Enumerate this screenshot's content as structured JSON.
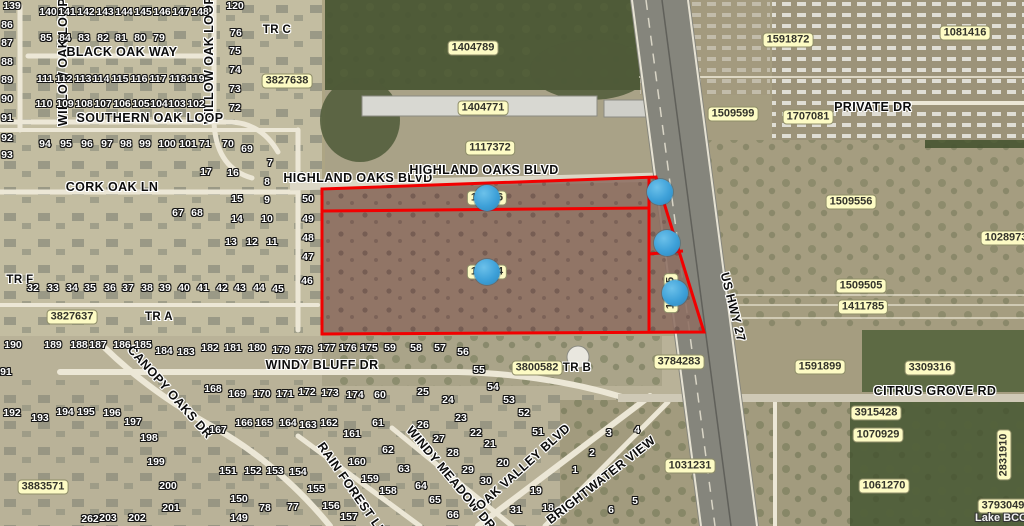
{
  "map": {
    "colors": {
      "parcel_outline": "#F20000",
      "marker_blue": "#3DA4DC",
      "label_yellow": "#FDFBC4"
    },
    "watermark": "Lake BCC",
    "parcel_labels": [
      {
        "t": "3827638",
        "x": 287,
        "y": 81,
        "rot": 0
      },
      {
        "t": "1404789",
        "x": 473,
        "y": 48,
        "rot": 0
      },
      {
        "t": "1404771",
        "x": 483,
        "y": 108,
        "rot": 0
      },
      {
        "t": "1117372",
        "x": 490,
        "y": 148,
        "rot": 0
      },
      {
        "t": "1591872",
        "x": 788,
        "y": 40,
        "rot": 0
      },
      {
        "t": "1509599",
        "x": 733,
        "y": 114,
        "rot": 0
      },
      {
        "t": "1707081",
        "x": 808,
        "y": 117,
        "rot": 0
      },
      {
        "t": "1081416",
        "x": 965,
        "y": 33,
        "rot": 0
      },
      {
        "t": "1509556",
        "x": 851,
        "y": 202,
        "rot": 0
      },
      {
        "t": "1028973",
        "x": 1006,
        "y": 238,
        "rot": 0
      },
      {
        "t": "1509505",
        "x": 861,
        "y": 286,
        "rot": 0
      },
      {
        "t": "1411785",
        "x": 863,
        "y": 307,
        "rot": 0
      },
      {
        "t": "3827637",
        "x": 72,
        "y": 317,
        "rot": 0
      },
      {
        "t": "3800582",
        "x": 537,
        "y": 368,
        "rot": 0
      },
      {
        "t": "3784283",
        "x": 679,
        "y": 362,
        "rot": 0
      },
      {
        "t": "1591899",
        "x": 820,
        "y": 367,
        "rot": 0
      },
      {
        "t": "3309316",
        "x": 930,
        "y": 368,
        "rot": 0
      },
      {
        "t": "3915428",
        "x": 876,
        "y": 413,
        "rot": 0
      },
      {
        "t": "1070929",
        "x": 878,
        "y": 435,
        "rot": 0
      },
      {
        "t": "1031231",
        "x": 690,
        "y": 466,
        "rot": 0
      },
      {
        "t": "1061270",
        "x": 884,
        "y": 486,
        "rot": 0
      },
      {
        "t": "2831910",
        "x": 1004,
        "y": 455,
        "rot": -90
      },
      {
        "t": "3793049",
        "x": 1003,
        "y": 506,
        "rot": 0
      },
      {
        "t": "3883571",
        "x": 43,
        "y": 487,
        "rot": 0
      }
    ],
    "partial_labels": [
      {
        "pre": "1",
        "suf": "6",
        "x": 487,
        "y": 198,
        "rot": 0
      },
      {
        "pre": "1",
        "suf": "4",
        "x": 487,
        "y": 272,
        "rot": 0
      },
      {
        "pre": "1",
        "suf": "5",
        "x": 671,
        "y": 293,
        "rot": -90
      }
    ],
    "street_labels": [
      {
        "t": "WILLOW OAK LOOP",
        "x": 63,
        "y": 62,
        "rot": -90
      },
      {
        "t": "WILLOW OAK LOOP",
        "x": 209,
        "y": 60,
        "rot": -90
      },
      {
        "t": "BLACK OAK WAY",
        "x": 122,
        "y": 52,
        "rot": 0
      },
      {
        "t": "SOUTHERN OAK LOOP",
        "x": 150,
        "y": 118,
        "rot": 0
      },
      {
        "t": "CORK OAK LN",
        "x": 112,
        "y": 187,
        "rot": 0
      },
      {
        "t": "HIGHLAND OAKS BLVD",
        "x": 358,
        "y": 178,
        "rot": 0
      },
      {
        "t": "HIGHLAND OAKS BLVD",
        "x": 484,
        "y": 170,
        "rot": 0
      },
      {
        "t": "PRIVATE DR",
        "x": 873,
        "y": 107,
        "rot": 0
      },
      {
        "t": "US HWY 27",
        "x": 733,
        "y": 307,
        "rot": 76
      },
      {
        "t": "CANOPY OAKS DR",
        "x": 170,
        "y": 392,
        "rot": 48
      },
      {
        "t": "WINDY BLUFF DR",
        "x": 322,
        "y": 365,
        "rot": 0
      },
      {
        "t": "RAIN FOREST LN",
        "x": 352,
        "y": 489,
        "rot": 55
      },
      {
        "t": "WINDY MEADOW DR",
        "x": 451,
        "y": 478,
        "rot": 50
      },
      {
        "t": "OAK VALLEY BLVD",
        "x": 523,
        "y": 467,
        "rot": -42
      },
      {
        "t": "BRIGHTWATER VIEW",
        "x": 601,
        "y": 480,
        "rot": -38
      },
      {
        "t": "CITRUS GROVE RD",
        "x": 935,
        "y": 391,
        "rot": 0
      },
      {
        "t": "TR C",
        "x": 277,
        "y": 30,
        "rot": 0
      },
      {
        "t": "TR F",
        "x": 20,
        "y": 280,
        "rot": 0
      },
      {
        "t": "TR A",
        "x": 159,
        "y": 317,
        "rot": 0
      },
      {
        "t": "TR B",
        "x": 577,
        "y": 368,
        "rot": 0
      }
    ],
    "lots": [
      [
        "139",
        12,
        6
      ],
      [
        "86",
        7,
        25
      ],
      [
        "87",
        7,
        43
      ],
      [
        "88",
        7,
        62
      ],
      [
        "89",
        7,
        80
      ],
      [
        "90",
        7,
        99
      ],
      [
        "91",
        7,
        118
      ],
      [
        "92",
        7,
        138
      ],
      [
        "93",
        7,
        155
      ],
      [
        "140",
        48,
        12
      ],
      [
        "141",
        67,
        12
      ],
      [
        "142",
        86,
        12
      ],
      [
        "143",
        105,
        12
      ],
      [
        "144",
        124,
        12
      ],
      [
        "145",
        143,
        12
      ],
      [
        "146",
        162,
        12
      ],
      [
        "147",
        181,
        12
      ],
      [
        "148",
        200,
        12
      ],
      [
        "85",
        46,
        38
      ],
      [
        "84",
        65,
        38
      ],
      [
        "83",
        84,
        38
      ],
      [
        "82",
        103,
        38
      ],
      [
        "81",
        121,
        38
      ],
      [
        "80",
        140,
        38
      ],
      [
        "79",
        159,
        38
      ],
      [
        "111",
        45,
        79
      ],
      [
        "112",
        64,
        79
      ],
      [
        "113",
        83,
        79
      ],
      [
        "114",
        101,
        79
      ],
      [
        "115",
        120,
        79
      ],
      [
        "116",
        139,
        79
      ],
      [
        "117",
        158,
        79
      ],
      [
        "118",
        178,
        79
      ],
      [
        "119",
        196,
        79
      ],
      [
        "110",
        44,
        104
      ],
      [
        "109",
        65,
        104
      ],
      [
        "108",
        84,
        104
      ],
      [
        "107",
        103,
        104
      ],
      [
        "106",
        122,
        104
      ],
      [
        "105",
        141,
        104
      ],
      [
        "104",
        159,
        104
      ],
      [
        "103",
        177,
        104
      ],
      [
        "102",
        196,
        104
      ],
      [
        "120",
        235,
        6
      ],
      [
        "76",
        236,
        33
      ],
      [
        "75",
        235,
        51
      ],
      [
        "74",
        235,
        70
      ],
      [
        "73",
        235,
        89
      ],
      [
        "72",
        235,
        108
      ],
      [
        "94",
        45,
        144
      ],
      [
        "95",
        66,
        144
      ],
      [
        "96",
        87,
        144
      ],
      [
        "97",
        107,
        144
      ],
      [
        "98",
        126,
        144
      ],
      [
        "99",
        145,
        144
      ],
      [
        "100",
        167,
        144
      ],
      [
        "101",
        188,
        144
      ],
      [
        "71",
        205,
        144
      ],
      [
        "70",
        228,
        144
      ],
      [
        "69",
        247,
        149
      ],
      [
        "7",
        270,
        163
      ],
      [
        "17",
        206,
        172
      ],
      [
        "16",
        233,
        173
      ],
      [
        "8",
        267,
        182
      ],
      [
        "15",
        237,
        199
      ],
      [
        "9",
        267,
        200
      ],
      [
        "67",
        178,
        213
      ],
      [
        "68",
        197,
        213
      ],
      [
        "14",
        237,
        219
      ],
      [
        "10",
        267,
        219
      ],
      [
        "13",
        231,
        242
      ],
      [
        "12",
        252,
        242
      ],
      [
        "11",
        272,
        242
      ],
      [
        "50",
        308,
        199
      ],
      [
        "49",
        308,
        219
      ],
      [
        "48",
        308,
        238
      ],
      [
        "47",
        308,
        257
      ],
      [
        "46",
        307,
        281
      ],
      [
        "45",
        278,
        289
      ],
      [
        "44",
        259,
        288
      ],
      [
        "43",
        240,
        288
      ],
      [
        "42",
        222,
        288
      ],
      [
        "41",
        203,
        288
      ],
      [
        "40",
        184,
        288
      ],
      [
        "39",
        165,
        288
      ],
      [
        "38",
        147,
        288
      ],
      [
        "37",
        128,
        288
      ],
      [
        "36",
        110,
        288
      ],
      [
        "35",
        90,
        288
      ],
      [
        "34",
        72,
        288
      ],
      [
        "33",
        53,
        288
      ],
      [
        "32",
        33,
        288
      ],
      [
        "190",
        13,
        345
      ],
      [
        "189",
        53,
        345
      ],
      [
        "188",
        79,
        345
      ],
      [
        "187",
        98,
        345
      ],
      [
        "186",
        122,
        345
      ],
      [
        "185",
        143,
        345
      ],
      [
        "184",
        164,
        351
      ],
      [
        "183",
        186,
        352
      ],
      [
        "182",
        210,
        348
      ],
      [
        "181",
        233,
        348
      ],
      [
        "180",
        257,
        348
      ],
      [
        "179",
        281,
        350
      ],
      [
        "178",
        304,
        350
      ],
      [
        "177",
        327,
        348
      ],
      [
        "176",
        348,
        348
      ],
      [
        "175",
        369,
        348
      ],
      [
        "191",
        3,
        372
      ],
      [
        "59",
        390,
        348
      ],
      [
        "58",
        416,
        348
      ],
      [
        "57",
        440,
        348
      ],
      [
        "56",
        463,
        352
      ],
      [
        "55",
        479,
        370
      ],
      [
        "54",
        493,
        387
      ],
      [
        "53",
        509,
        400
      ],
      [
        "52",
        524,
        413
      ],
      [
        "51",
        538,
        432
      ],
      [
        "172",
        307,
        392
      ],
      [
        "173",
        330,
        393
      ],
      [
        "174",
        355,
        395
      ],
      [
        "60",
        380,
        395
      ],
      [
        "25",
        423,
        392
      ],
      [
        "24",
        448,
        400
      ],
      [
        "23",
        461,
        418
      ],
      [
        "192",
        12,
        413
      ],
      [
        "193",
        40,
        418
      ],
      [
        "194",
        65,
        412
      ],
      [
        "195",
        86,
        412
      ],
      [
        "196",
        112,
        413
      ],
      [
        "197",
        133,
        422
      ],
      [
        "198",
        149,
        438
      ],
      [
        "199",
        156,
        462
      ],
      [
        "200",
        168,
        486
      ],
      [
        "201",
        171,
        508
      ],
      [
        "202",
        137,
        518
      ],
      [
        "203",
        108,
        518
      ],
      [
        "262",
        90,
        519
      ],
      [
        "168",
        213,
        389
      ],
      [
        "169",
        237,
        394
      ],
      [
        "170",
        262,
        394
      ],
      [
        "171",
        285,
        394
      ],
      [
        "167",
        218,
        430
      ],
      [
        "166",
        244,
        423
      ],
      [
        "165",
        264,
        423
      ],
      [
        "164",
        288,
        423
      ],
      [
        "151",
        228,
        471
      ],
      [
        "152",
        253,
        471
      ],
      [
        "153",
        275,
        471
      ],
      [
        "154",
        298,
        472
      ],
      [
        "155",
        316,
        489
      ],
      [
        "156",
        331,
        506
      ],
      [
        "157",
        349,
        517
      ],
      [
        "158",
        388,
        491
      ],
      [
        "159",
        370,
        479
      ],
      [
        "160",
        357,
        462
      ],
      [
        "161",
        352,
        434
      ],
      [
        "162",
        329,
        423
      ],
      [
        "163",
        308,
        425
      ],
      [
        "150",
        239,
        499
      ],
      [
        "149",
        239,
        518
      ],
      [
        "78",
        265,
        508
      ],
      [
        "77",
        293,
        507
      ],
      [
        "61",
        378,
        423
      ],
      [
        "26",
        423,
        425
      ],
      [
        "22",
        476,
        433
      ],
      [
        "27",
        439,
        439
      ],
      [
        "62",
        388,
        450
      ],
      [
        "21",
        490,
        444
      ],
      [
        "28",
        453,
        453
      ],
      [
        "20",
        503,
        463
      ],
      [
        "29",
        468,
        470
      ],
      [
        "63",
        404,
        469
      ],
      [
        "30",
        486,
        481
      ],
      [
        "19",
        536,
        491
      ],
      [
        "64",
        421,
        486
      ],
      [
        "65",
        435,
        500
      ],
      [
        "31",
        516,
        510
      ],
      [
        "18",
        548,
        508
      ],
      [
        "66",
        453,
        515
      ],
      [
        "3",
        609,
        433
      ],
      [
        "4",
        637,
        430
      ],
      [
        "2",
        592,
        453
      ],
      [
        "1",
        575,
        470
      ],
      [
        "5",
        635,
        501
      ],
      [
        "6",
        611,
        510
      ]
    ],
    "markers": [
      {
        "x": 487,
        "y": 198
      },
      {
        "x": 487,
        "y": 272
      },
      {
        "x": 660,
        "y": 192
      },
      {
        "x": 667,
        "y": 243
      },
      {
        "x": 675,
        "y": 293
      }
    ]
  }
}
